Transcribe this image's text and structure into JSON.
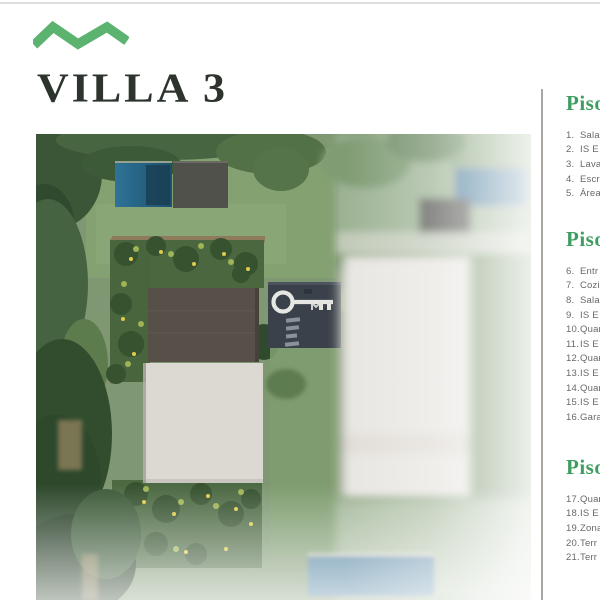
{
  "page": {
    "title": "VILLA 3"
  },
  "palette": {
    "brand_green": "#5cb36f",
    "heading_green": "#3f9d62",
    "title_color": "#2d342e",
    "list_text_gray": "#686868",
    "divider_gray": "#a8a8a3"
  },
  "floors": [
    {
      "heading": "Piso",
      "items": [
        {
          "num": "1.",
          "label": "Sala"
        },
        {
          "num": "2.",
          "label": "IS E"
        },
        {
          "num": "3.",
          "label": "Lava"
        },
        {
          "num": "4.",
          "label": "Escr"
        },
        {
          "num": "5.",
          "label": "Área"
        }
      ]
    },
    {
      "heading": "Piso",
      "items": [
        {
          "num": "6.",
          "label": "Entr"
        },
        {
          "num": "7.",
          "label": "Cozi"
        },
        {
          "num": "8.",
          "label": "Sala"
        },
        {
          "num": "9.",
          "label": "IS E"
        },
        {
          "num": "10.",
          "label": "Quar"
        },
        {
          "num": "11.",
          "label": "IS E"
        },
        {
          "num": "12.",
          "label": "Quar"
        },
        {
          "num": "13.",
          "label": "IS E"
        },
        {
          "num": "14.",
          "label": "Quar"
        },
        {
          "num": "15.",
          "label": "IS E"
        },
        {
          "num": "16.",
          "label": "Gara"
        }
      ]
    },
    {
      "heading": "Piso",
      "items": [
        {
          "num": "17.",
          "label": "Quar"
        },
        {
          "num": "18.",
          "label": "IS E"
        },
        {
          "num": "19.",
          "label": "Zona"
        },
        {
          "num": "20.",
          "label": "Terr"
        },
        {
          "num": "21.",
          "label": "Terr"
        }
      ]
    }
  ]
}
